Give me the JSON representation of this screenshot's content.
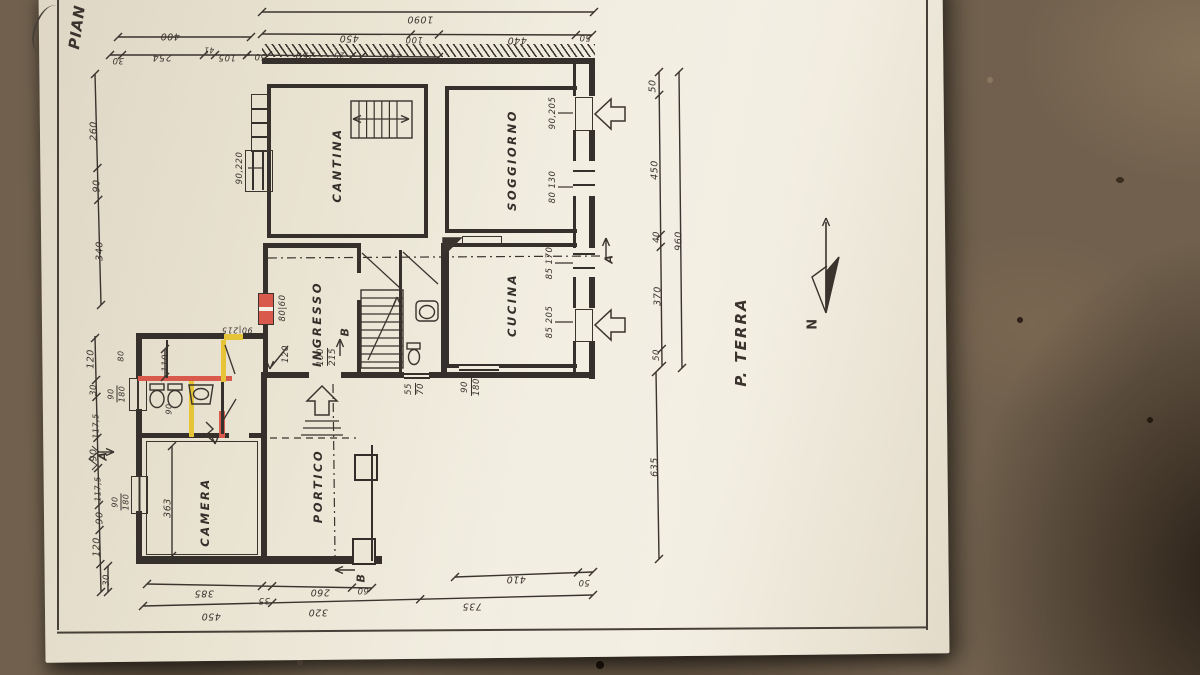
{
  "sheet": {
    "title_partial": "PIAN",
    "floor_label": "P. TERRA",
    "north_label": "N"
  },
  "colors": {
    "paper": "#eae4d3",
    "ink": "#3a332e",
    "highlight_red": "#d95a4c",
    "highlight_yellow": "#e5c437",
    "table_brown": "#70604d"
  },
  "rooms": [
    {
      "id": "cantina",
      "label": "CANTINA",
      "x": 337,
      "y": 165
    },
    {
      "id": "soggiorno",
      "label": "SOGGIORNO",
      "x": 512,
      "y": 160
    },
    {
      "id": "cucina",
      "label": "CUCINA",
      "x": 512,
      "y": 305
    },
    {
      "id": "ingresso",
      "label": "INGRESSO",
      "x": 317,
      "y": 324
    },
    {
      "id": "portico",
      "label": "PORTICO",
      "x": 318,
      "y": 486
    },
    {
      "id": "camera",
      "label": "CAMERA",
      "x": 205,
      "y": 512
    }
  ],
  "dims": [
    {
      "t": "1090",
      "x": 420,
      "y": 19,
      "r": "ud"
    },
    {
      "t": "400",
      "x": 170,
      "y": 36,
      "r": "ud"
    },
    {
      "t": "450",
      "x": 349,
      "y": 38,
      "r": "ud"
    },
    {
      "t": "100",
      "x": 414,
      "y": 39,
      "r": "ud",
      "s": 8.5
    },
    {
      "t": "440",
      "x": 517,
      "y": 40,
      "r": "ud"
    },
    {
      "t": "50",
      "x": 585,
      "y": 37,
      "r": "ud",
      "s": 8.5
    },
    {
      "t": "30",
      "x": 118,
      "y": 60,
      "r": "ud",
      "s": 8.5
    },
    {
      "t": "254",
      "x": 162,
      "y": 57,
      "r": "ud"
    },
    {
      "t": "41",
      "x": 209,
      "y": 50,
      "r": "ud",
      "s": 7.5
    },
    {
      "t": "105",
      "x": 227,
      "y": 57,
      "r": "ud",
      "s": 8.5
    },
    {
      "t": "50",
      "x": 260,
      "y": 56,
      "r": "ud",
      "s": 8.5
    },
    {
      "t": "250",
      "x": 305,
      "y": 55,
      "r": "ud"
    },
    {
      "t": "25",
      "x": 339,
      "y": 55,
      "r": "ud",
      "s": 7.5
    },
    {
      "t": "210",
      "x": 392,
      "y": 57,
      "r": "ud"
    },
    {
      "t": "260",
      "x": 94,
      "y": 131,
      "r": "v"
    },
    {
      "t": "90",
      "x": 97,
      "y": 186,
      "r": "v"
    },
    {
      "t": "340",
      "x": 100,
      "y": 251,
      "r": "v"
    },
    {
      "t": "120",
      "x": 91,
      "y": 359,
      "r": "v"
    },
    {
      "t": "30",
      "x": 94,
      "y": 390,
      "r": "v",
      "s": 8.5
    },
    {
      "t": "117,5",
      "x": 96,
      "y": 426,
      "r": "v",
      "s": 8
    },
    {
      "t": "90",
      "x": 94,
      "y": 455,
      "r": "v"
    },
    {
      "t": "117,5",
      "x": 98,
      "y": 489,
      "r": "v",
      "s": 8
    },
    {
      "t": "90",
      "x": 100,
      "y": 518,
      "r": "v"
    },
    {
      "t": "120",
      "x": 97,
      "y": 547,
      "r": "v"
    },
    {
      "t": "30",
      "x": 107,
      "y": 580,
      "r": "v",
      "s": 8.5
    },
    {
      "t": "50",
      "x": 653,
      "y": 86,
      "r": "v"
    },
    {
      "t": "450",
      "x": 655,
      "y": 170,
      "r": "v"
    },
    {
      "t": "40",
      "x": 657,
      "y": 237,
      "r": "v",
      "s": 8.5
    },
    {
      "t": "370",
      "x": 658,
      "y": 296,
      "r": "v"
    },
    {
      "t": "50",
      "x": 657,
      "y": 355,
      "r": "v",
      "s": 8.5
    },
    {
      "t": "960",
      "x": 679,
      "y": 241,
      "r": "v"
    },
    {
      "t": "635",
      "x": 655,
      "y": 467,
      "r": "v"
    },
    {
      "t": "385",
      "x": 204,
      "y": 593,
      "r": "ud"
    },
    {
      "t": "35",
      "x": 264,
      "y": 600,
      "r": "ud",
      "s": 8.5
    },
    {
      "t": "260",
      "x": 320,
      "y": 592,
      "r": "ud"
    },
    {
      "t": "60",
      "x": 363,
      "y": 590,
      "r": "ud",
      "s": 8.5
    },
    {
      "t": "450",
      "x": 211,
      "y": 616,
      "r": "ud"
    },
    {
      "t": "320",
      "x": 318,
      "y": 612,
      "r": "ud"
    },
    {
      "t": "735",
      "x": 472,
      "y": 606,
      "r": "ud"
    },
    {
      "t": "410",
      "x": 516,
      "y": 579,
      "r": "ud"
    },
    {
      "t": "50",
      "x": 584,
      "y": 582,
      "r": "ud",
      "s": 8.5
    }
  ],
  "openings": [
    {
      "t": "90,220",
      "x": 240,
      "y": 168,
      "r": "v",
      "s": 8.5
    },
    {
      "t": "90,205",
      "x": 553,
      "y": 113,
      "r": "v",
      "s": 8.5
    },
    {
      "t": "80 130",
      "x": 553,
      "y": 187,
      "r": "v",
      "s": 8.5
    },
    {
      "t": "85 170",
      "x": 550,
      "y": 263,
      "r": "v",
      "s": 8.5
    },
    {
      "t": "85 205",
      "x": 550,
      "y": 322,
      "r": "v",
      "s": 8.5
    },
    {
      "t": "80|60",
      "x": 283,
      "y": 308,
      "r": "v",
      "s": 8.5
    },
    {
      "t": "120",
      "x": 286,
      "y": 354,
      "r": "v",
      "s": 8.5
    },
    {
      "parts": [
        "100",
        "215"
      ],
      "x": 327,
      "y": 357,
      "r": "v",
      "s": 8.5
    },
    {
      "parts": [
        "55",
        "70"
      ],
      "x": 415,
      "y": 389,
      "r": "v",
      "s": 8.5
    },
    {
      "parts": [
        "90",
        "180"
      ],
      "x": 471,
      "y": 387,
      "r": "v",
      "s": 8.5
    },
    {
      "t": "90|215",
      "x": 237,
      "y": 330,
      "r": "ud",
      "s": 8
    },
    {
      "parts": [
        "90",
        "180"
      ],
      "x": 117,
      "y": 394,
      "r": "v",
      "s": 8
    },
    {
      "parts": [
        "90",
        "180"
      ],
      "x": 121,
      "y": 502,
      "r": "v",
      "s": 8
    },
    {
      "t": "363",
      "x": 168,
      "y": 508,
      "r": "v"
    },
    {
      "t": "110",
      "x": 166,
      "y": 363,
      "r": "v",
      "s": 8.5
    },
    {
      "t": "80",
      "x": 121,
      "y": 356,
      "r": "v",
      "s": 8
    },
    {
      "t": "90",
      "x": 169,
      "y": 409,
      "r": "v",
      "s": 8
    }
  ],
  "markers": [
    {
      "t": "A",
      "x": 609,
      "y": 259
    },
    {
      "t": "A",
      "x": 103,
      "y": 456
    },
    {
      "t": "B",
      "x": 345,
      "y": 332
    },
    {
      "t": "B",
      "x": 361,
      "y": 578
    }
  ]
}
